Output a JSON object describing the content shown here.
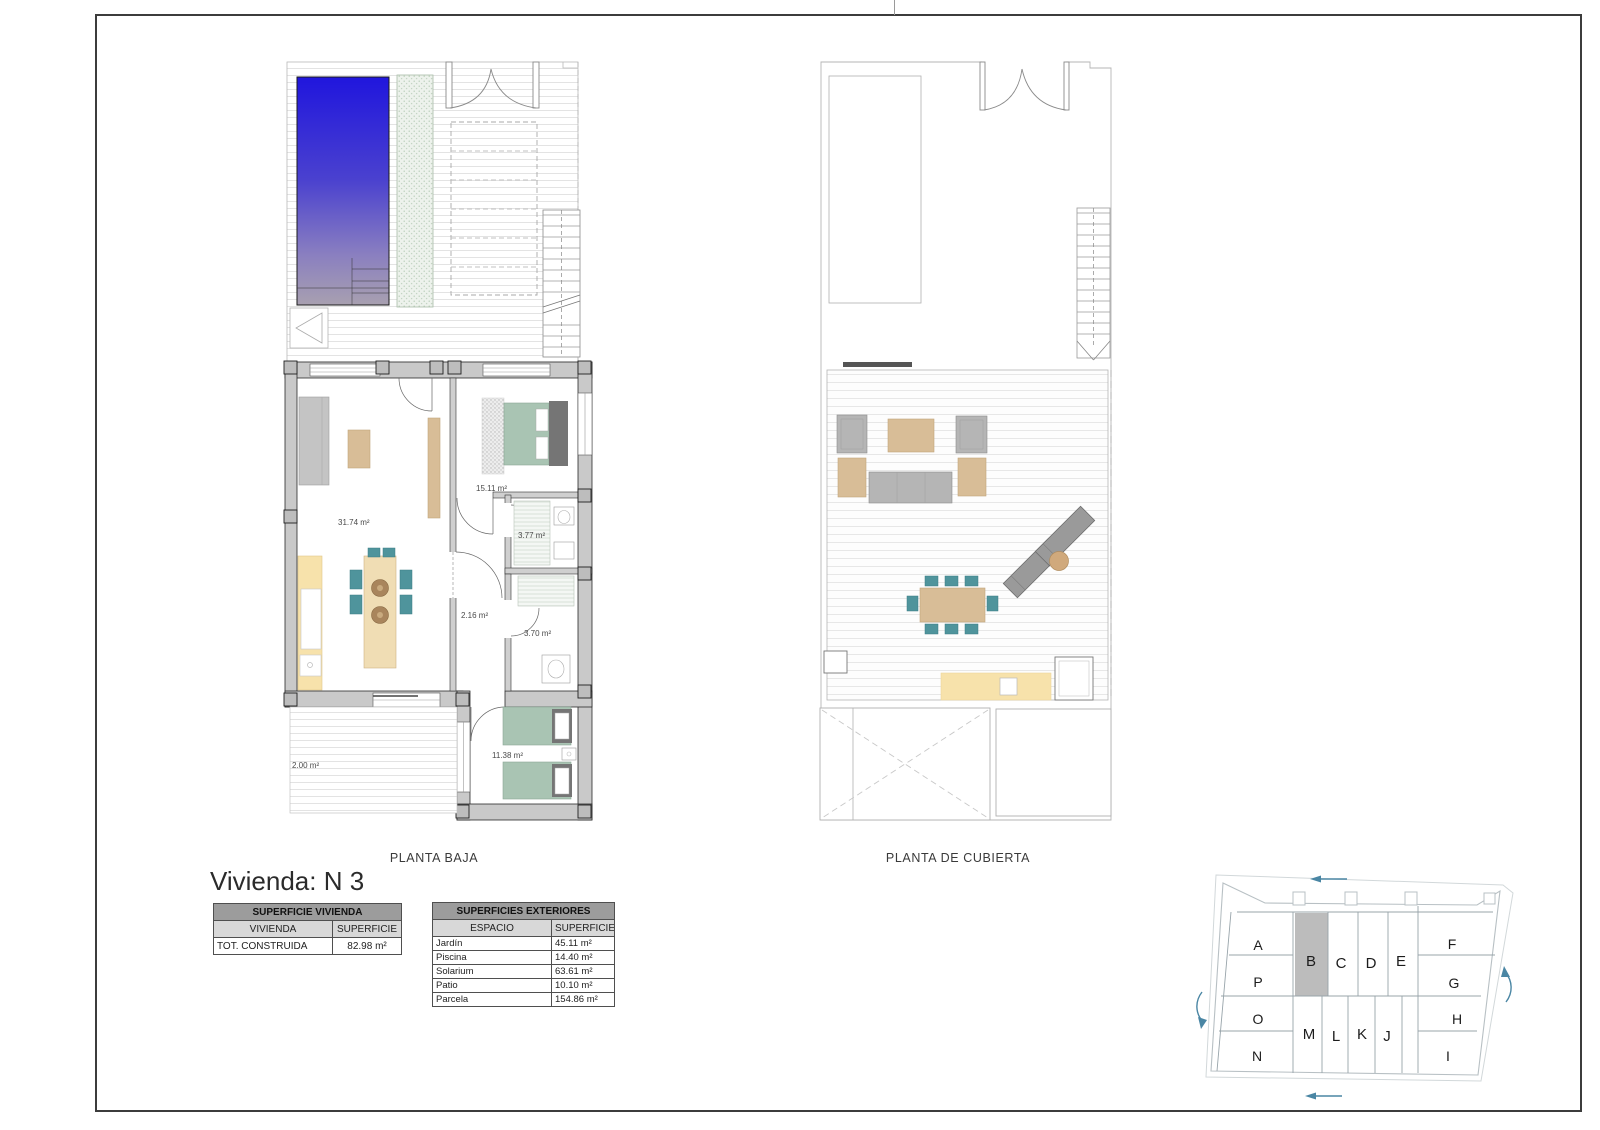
{
  "sheet": {
    "title": "Vivienda: N 3"
  },
  "plans": {
    "baja": {
      "caption": "PLANTA BAJA",
      "rooms": {
        "living": "31.74 m²",
        "bedroom1": "15.11 m²",
        "bath1": "3.77 m²",
        "hall": "2.16 m²",
        "bath2": "3.70 m²",
        "bedroom2": "11.38 m²",
        "patio": "2.00 m²"
      }
    },
    "cubierta": {
      "caption": "PLANTA DE CUBIERTA"
    }
  },
  "tables": {
    "vivienda": {
      "title": "SUPERFICIE VIVIENDA",
      "col1": "VIVIENDA",
      "col2": "SUPERFICIE",
      "rows": [
        {
          "label": "TOT. CONSTRUIDA",
          "value": "82.98 m²"
        }
      ]
    },
    "exteriores": {
      "title": "SUPERFICIES EXTERIORES",
      "col1": "ESPACIO",
      "col2": "SUPERFICIE",
      "rows": [
        {
          "label": "Jardín",
          "value": "45.11 m²"
        },
        {
          "label": "Piscina",
          "value": "14.40 m²"
        },
        {
          "label": "Solarium",
          "value": "63.61 m²"
        },
        {
          "label": "Patio",
          "value": "10.10 m²"
        },
        {
          "label": "Parcela",
          "value": "154.86 m²"
        }
      ]
    }
  },
  "keyplan": {
    "highlighted_unit": "B",
    "units": {
      "a": "A",
      "b": "B",
      "c": "C",
      "d": "D",
      "e": "E",
      "f": "F",
      "g": "G",
      "h": "H",
      "i": "I",
      "j": "J",
      "k": "K",
      "l": "L",
      "m": "M",
      "n": "N",
      "o": "O",
      "p": "P"
    }
  },
  "colors": {
    "pool_blue": "#2016dd",
    "furniture_teal": "#4f949c",
    "bed_sage": "#a9c4b3",
    "wood_tan": "#d8bd97",
    "kitchen_cream": "#f7e2ab",
    "wall_gray": "#c9c9c9",
    "keyplan_arrow_blue": "#4a86a4",
    "keyplan_highlight": "#bcbcbc"
  }
}
